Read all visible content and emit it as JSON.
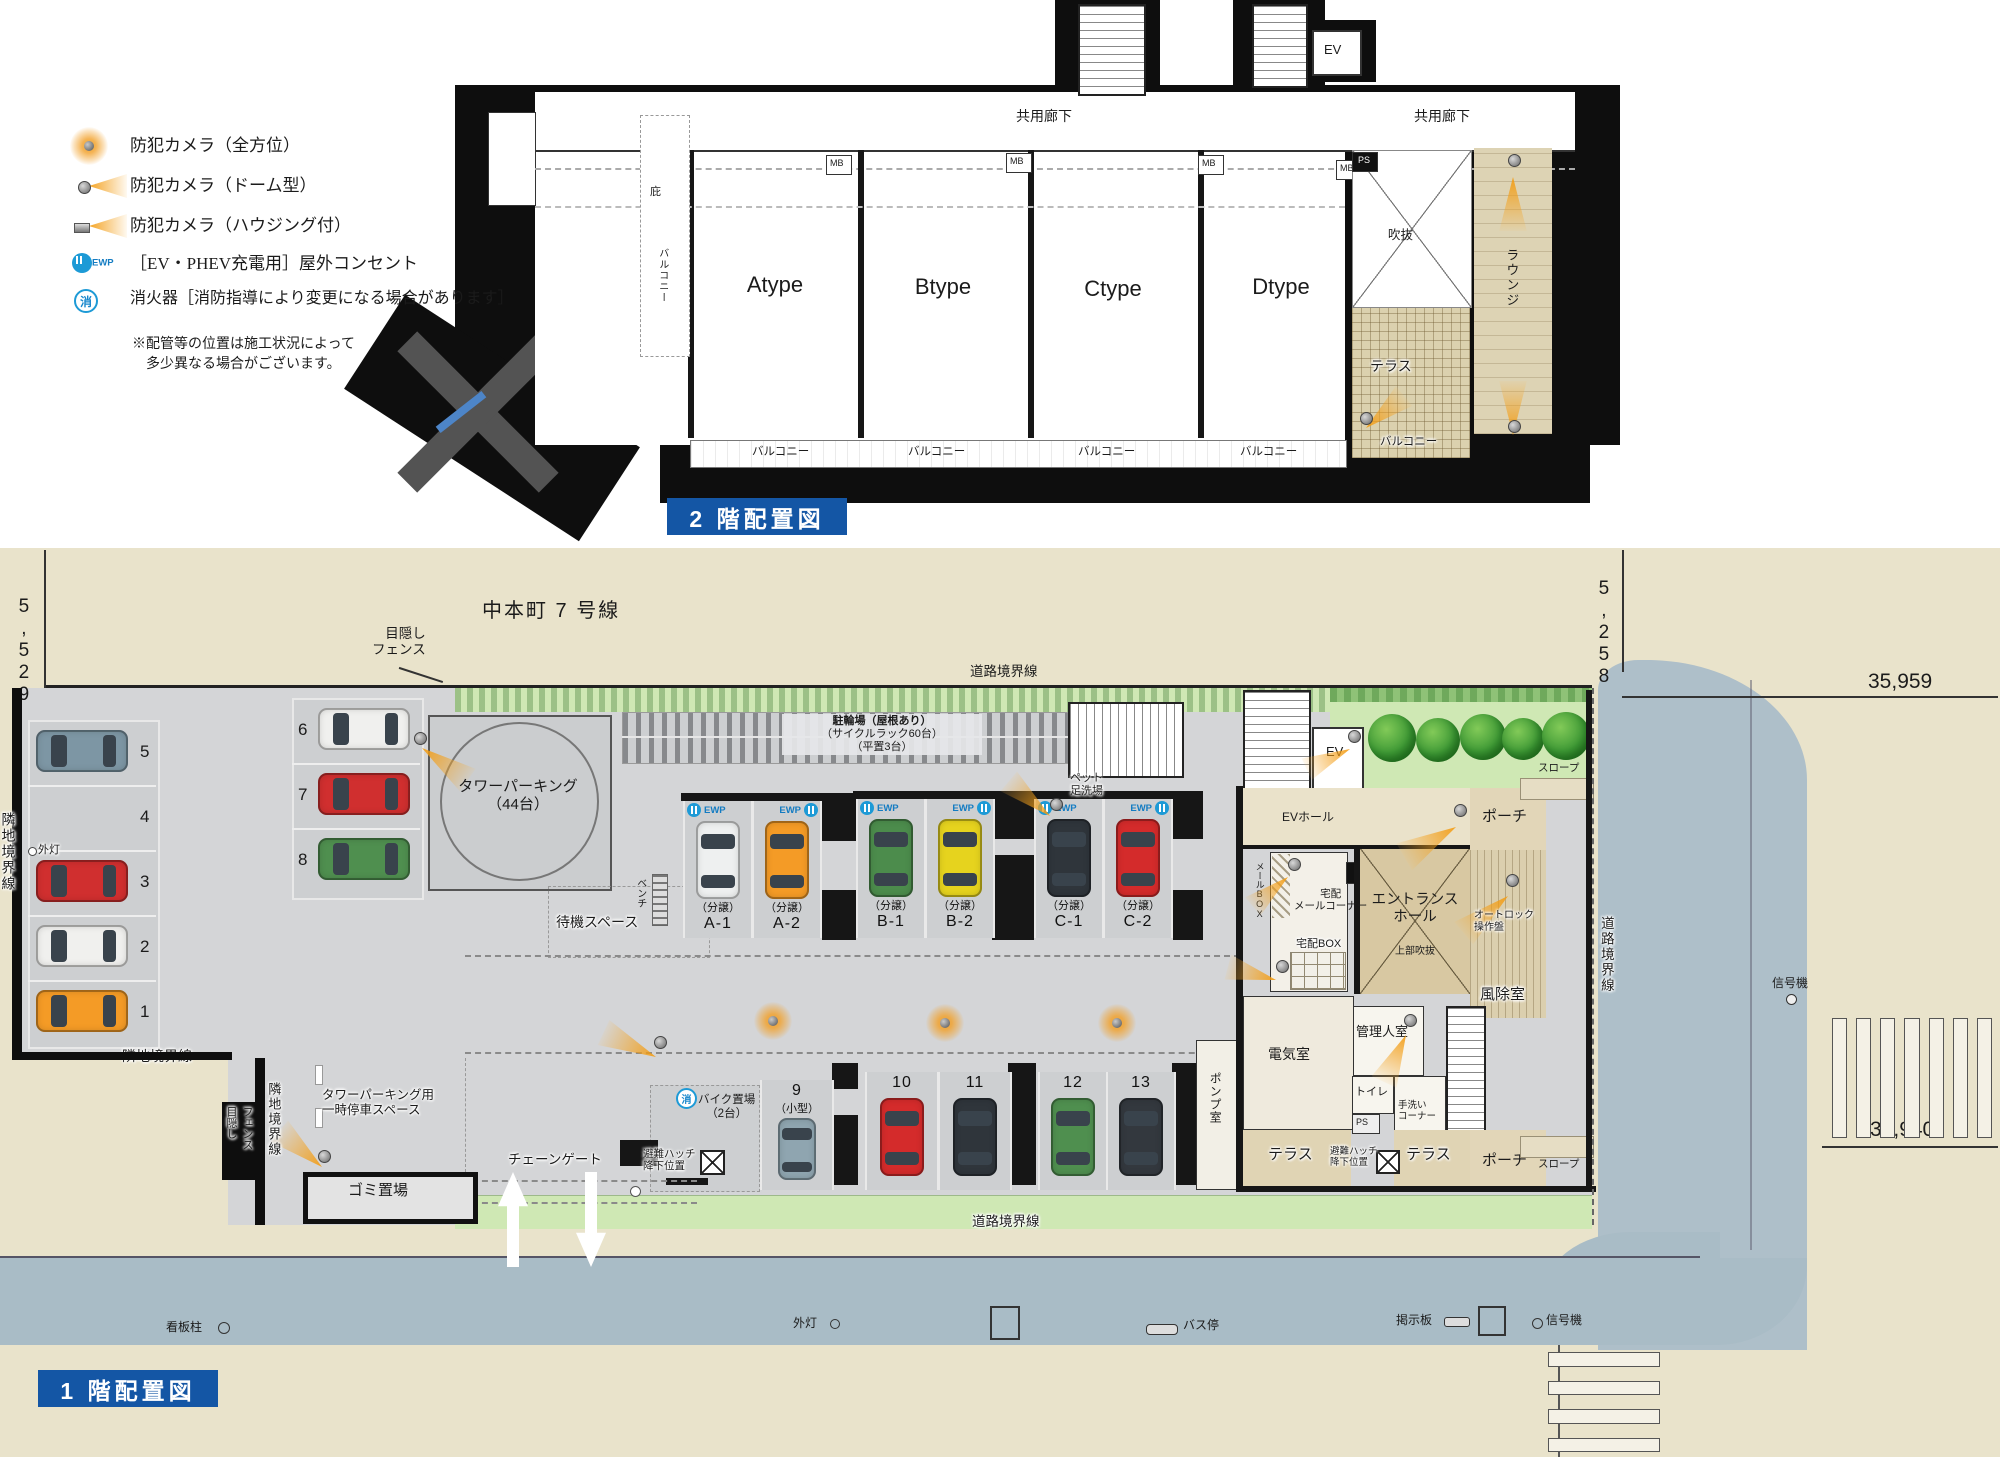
{
  "common": {
    "ewp": "EWP"
  },
  "legend": {
    "items": [
      {
        "label": "防犯カメラ（全方位）"
      },
      {
        "label": "防犯カメラ（ドーム型）"
      },
      {
        "label": "防犯カメラ（ハウジング付）"
      },
      {
        "label": "［EV・PHEV充電用］屋外コンセント"
      },
      {
        "label": "消火器［消防指導により変更になる場合があります］"
      }
    ],
    "fire_glyph": "消",
    "note_line1": "※配管等の位置は施工状況によって",
    "note_line2": "多少異なる場合がございます。"
  },
  "f2": {
    "title": "2 階配置図",
    "corridors": [
      {
        "t": "共用廊下"
      },
      {
        "t": "共用廊下"
      }
    ],
    "units": [
      {
        "name": "Atype"
      },
      {
        "name": "Btype"
      },
      {
        "name": "Ctype"
      },
      {
        "name": "Dtype"
      }
    ],
    "mb": [
      {
        "t": "MB"
      },
      {
        "t": "MB"
      },
      {
        "t": "MB"
      },
      {
        "t": "MB"
      }
    ],
    "ps": "PS",
    "ev": "EV",
    "hisashi": "庇",
    "balcony_side": "バルコニー",
    "void": "吹抜",
    "terrace": "テラス",
    "lounge": "ラウンジ",
    "balconies": [
      {
        "t": "バルコニー"
      },
      {
        "t": "バルコニー"
      },
      {
        "t": "バルコニー"
      },
      {
        "t": "バルコニー"
      }
    ],
    "balcony_annex": "バルコニー"
  },
  "f1": {
    "title": "1 階配置図",
    "street_north": "中本町 7 号線",
    "dims": {
      "left": "5,529",
      "right": "5,258",
      "top": "35,959",
      "bottom": "35,940"
    },
    "road_boundary": [
      {
        "t": "道路境界線"
      },
      {
        "t": "道路境界線"
      },
      {
        "t": "道路境界線"
      }
    ],
    "neighbor": [
      {
        "t": "隣地境界線"
      },
      {
        "t": "隣地境界線"
      },
      {
        "t": "隣地境界線"
      }
    ],
    "fence": {
      "l1": "目隠し",
      "l2": "フェンス"
    },
    "gaito": [
      {
        "t": "外灯"
      },
      {
        "t": "外灯"
      }
    ],
    "left_stalls": [
      {
        "no": "5"
      },
      {
        "no": "4"
      },
      {
        "no": "3"
      },
      {
        "no": "2"
      },
      {
        "no": "1"
      }
    ],
    "mid_stalls": [
      {
        "no": "6"
      },
      {
        "no": "7"
      },
      {
        "no": "8"
      }
    ],
    "tower": {
      "l1": "タワーパーキング",
      "l2": "（44台）"
    },
    "wait": "待機スペース",
    "bench": "ベンチ",
    "bicycle": {
      "l1": "駐輪場（屋根あり）",
      "l2": "（サイクルラック60台）",
      "l3": "（平置3台）"
    },
    "pet": {
      "l1": "ペット",
      "l2": "足洗場"
    },
    "bunjo": "（分譲）",
    "stallsA": [
      {
        "id": "A-1"
      },
      {
        "id": "A-2"
      }
    ],
    "stallsB": [
      {
        "id": "B-1"
      },
      {
        "id": "B-2"
      }
    ],
    "stallsC": [
      {
        "id": "C-1"
      },
      {
        "id": "C-2"
      }
    ],
    "lower_stalls": [
      {
        "no": "9"
      },
      {
        "no": "10"
      },
      {
        "no": "11"
      },
      {
        "no": "12"
      },
      {
        "no": "13"
      }
    ],
    "kogata": "（小型）",
    "bike": {
      "l1": "バイク置場",
      "l2": "（2台）"
    },
    "pump": "ポンプ室",
    "gate": "チェーンゲート",
    "trash": "ゴミ置場",
    "temp": {
      "l1": "タワーパーキング用",
      "l2": "一時停車スペース"
    },
    "hatch": {
      "l1": "避難ハッチ",
      "l2": "降下位置"
    },
    "ev": "EV",
    "ev_hall": "EVホール",
    "porch": [
      {
        "t": "ポーチ"
      },
      {
        "t": "ポーチ"
      }
    ],
    "slope": [
      {
        "t": "スロープ"
      },
      {
        "t": "スロープ"
      }
    ],
    "entrance": {
      "l1": "エントランス",
      "l2": "ホール"
    },
    "upper_void": "上部吹抜",
    "windbreak": "風除室",
    "autolock": {
      "l1": "オートロック",
      "l2": "操作盤"
    },
    "mailbox": "メールBOX",
    "takuhai": "宅配",
    "mail_corner": "メールコーナー",
    "takuhai_box": "宅配BOX",
    "ps": "PS",
    "manager": "管理人室",
    "electric": "電気室",
    "toilet": "トイレ",
    "tearai": {
      "l1": "手洗い",
      "l2": "コーナー"
    },
    "terrace": [
      {
        "t": "テラス"
      },
      {
        "t": "テラス"
      }
    ],
    "signpost": "看板柱",
    "busstop": "バス停",
    "board": "掲示板",
    "signal": [
      {
        "t": "信号機"
      },
      {
        "t": "信号機"
      }
    ]
  }
}
